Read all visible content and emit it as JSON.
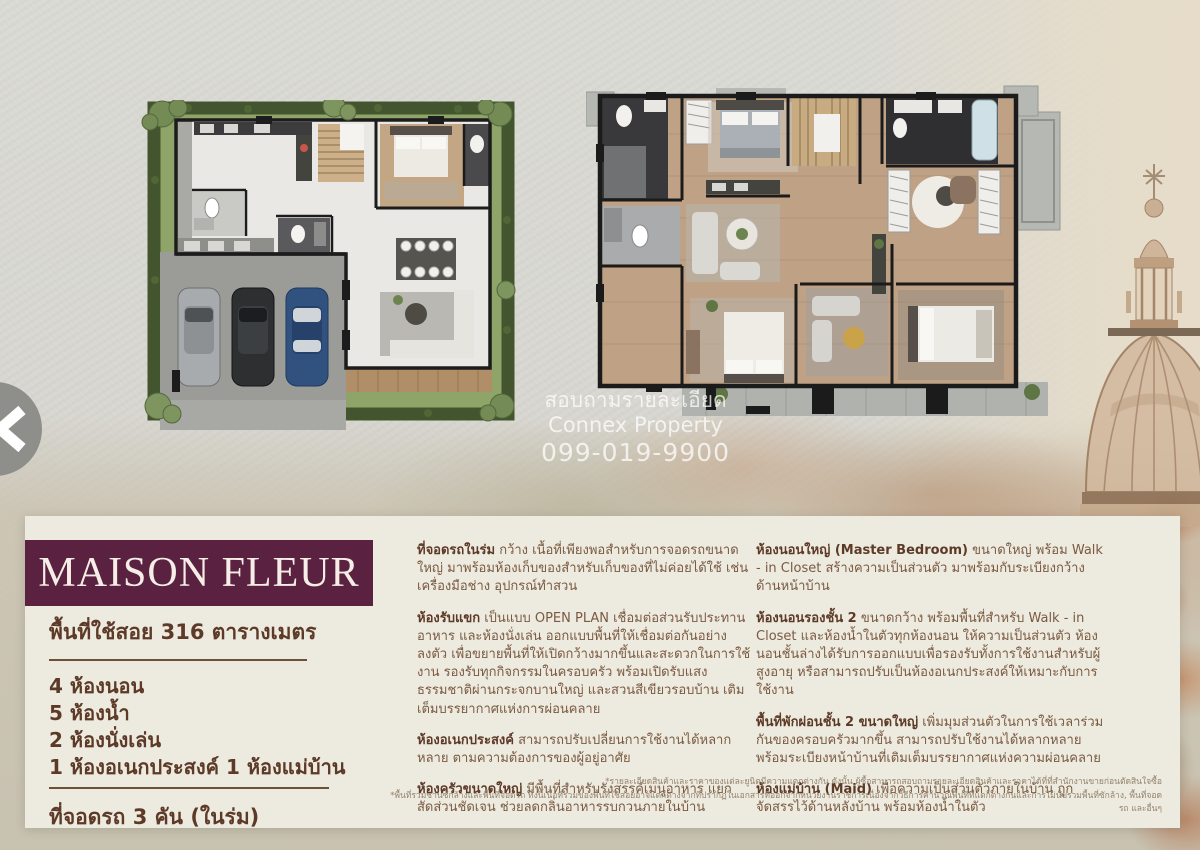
{
  "colors": {
    "banner": "#5a2140",
    "panel_bg": "#edeadf",
    "heading_text": "#5d3a27",
    "body_text": "#7a5a41",
    "footnote_text": "#93826d",
    "hedge_green": "#43552e",
    "grass_green": "#8fa468"
  },
  "watermark": {
    "line1": "สอบถามรายละเอียด",
    "line2": "Connex Property",
    "line3": "099-019-9900"
  },
  "panel": {
    "title": "MAISON FLEUR",
    "area_line": "พื้นที่ใช้สอย 316 ตารางเมตร",
    "spec_lines": [
      "4 ห้องนอน",
      "5 ห้องน้ำ",
      "2 ห้องนั่งเล่น",
      "1 ห้องอเนกประสงค์ 1 ห้องแม่บ้าน"
    ],
    "parking_line": "ที่จอดรถ 3 คัน (ในร่ม)",
    "col2": [
      {
        "head": "ที่จอดรถในร่ม",
        "body": " กว้าง เนื้อที่เพียงพอสำหรับการจอดรถขนาดใหญ่ มาพร้อมห้องเก็บของสำหรับเก็บของที่ไม่ค่อยได้ใช้ เช่น เครื่องมือช่าง อุปกรณ์ทำสวน"
      },
      {
        "head": "ห้องรับแขก",
        "body": " เป็นแบบ OPEN PLAN เชื่อมต่อส่วนรับประทานอาหาร และห้องนั่งเล่น ออกแบบพื้นที่ให้เชื่อมต่อกันอย่างลงตัว เพื่อขยายพื้นที่ให้เปิดกว้างมากขึ้นและสะดวกในการใช้งาน รองรับทุกกิจกรรมในครอบครัว พร้อมเปิดรับแสงธรรมชาติผ่านกระจกบานใหญ่ และสวนสีเขียวรอบบ้าน เติมเต็มบรรยากาศแห่งการผ่อนคลาย"
      },
      {
        "head": "ห้องอเนกประสงค์",
        "body": " สามารถปรับเปลี่ยนการใช้งานได้หลากหลาย ตามความต้องการของผู้อยู่อาศัย"
      },
      {
        "head": "ห้องครัวขนาดใหญ่",
        "body": " มีพื้นที่สำหรับรังสรรค์เมนูอาหาร แยกสัดส่วนชัดเจน ช่วยลดกลิ่นอาหารรบกวนภายในบ้าน"
      }
    ],
    "col3": [
      {
        "head": "ห้องนอนใหญ่ (Master Bedroom)",
        "body": " ขนาดใหญ่ พร้อม Walk - in Closet สร้างความเป็นส่วนตัว มาพร้อมกับระเบียงกว้างด้านหน้าบ้าน"
      },
      {
        "head": "ห้องนอนรองชั้น 2",
        "body": " ขนาดกว้าง พร้อมพื้นที่สำหรับ Walk - in Closet และห้องน้ำในตัวทุกห้องนอน ให้ความเป็นส่วนตัว ห้องนอนชั้นล่างได้รับการออกแบบเพื่อรองรับทั้งการใช้งานสำหรับผู้สูงอายุ หรือสามารถปรับเป็นห้องอเนกประสงค์ให้เหมาะกับการใช้งาน"
      },
      {
        "head": "พื้นที่พักผ่อนชั้น 2 ขนาดใหญ่",
        "body": " เพิ่มมุมส่วนตัวในการใช้เวลาร่วมกันของครอบครัวมากขึ้น สามารถปรับใช้งานได้หลากหลาย พร้อมระเบียงหน้าบ้านที่เติมเต็มบรรยากาศแห่งความผ่อนคลาย"
      },
      {
        "head": "ห้องแม่บ้าน (Maid)",
        "body": " เพื่อความเป็นส่วนตัวภายในบ้าน ถูกจัดสรรไว้ด้านหลังบ้าน พร้อมห้องน้ำในตัว"
      }
    ],
    "footnotes": [
      "*รายละเอียดสินค้าและราคาของแต่ละยูนิตมีความแตกต่างกัน ดังนั้น ผู้ซื้อสามารถสอบถามรายละเอียดสินค้าและราคาได้ที่ที่สำนักงานขายก่อนตัดสินใจซื้อ",
      "*พื้นที่รวมชานซักล้างและพื้นที่จอดรถ ทั้งนี้เนื้อที่รวมของพื้นที่ใช้สอยอาจแตกต่างจากที่ปรากฏในเอกสารที่ออกจากหน่วยงานราชการเนื่องจากวิธีการคำนวณพื้นที่ที่แตกต่างกันและการไม่นับรวมพื้นที่ซักล้าง, พื้นที่จอดรถ และอื่นๆ"
    ]
  }
}
